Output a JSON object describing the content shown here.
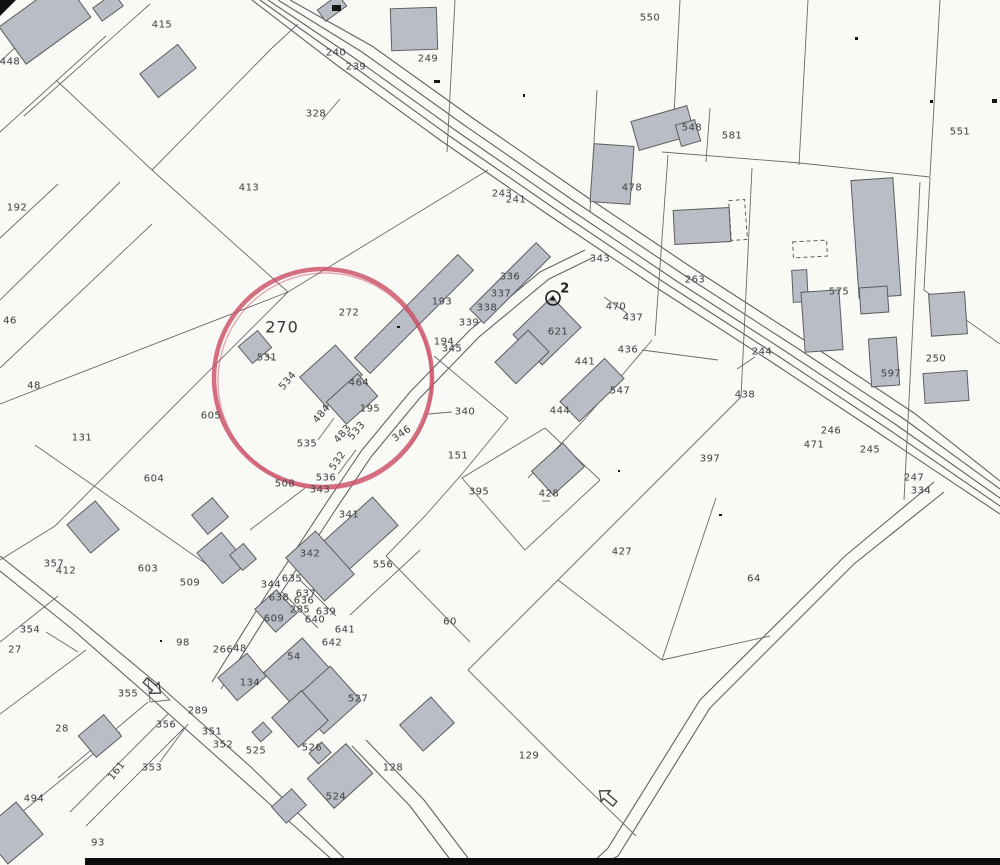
{
  "map": {
    "type": "cadastral-parcel-map",
    "highlight": {
      "label": "270",
      "cx": 323,
      "cy": 378,
      "rx": 109,
      "ry": 109,
      "color": "#cb4c63"
    },
    "colors": {
      "paper": "#f9f9f6",
      "line": "#6b6b6b",
      "building_fill": "#b9bdc5",
      "building_stroke": "#5e5e5e",
      "text": "#474747",
      "highlight_circle": "#cb4c63"
    },
    "symbols": [
      {
        "name": "benchmark-icon",
        "label": "2",
        "x": 553,
        "y": 298
      },
      {
        "name": "road-arrow-icon",
        "x": 152,
        "y": 686,
        "rot": 40
      },
      {
        "name": "road-arrow-icon",
        "x": 608,
        "y": 798,
        "rot": 220
      }
    ],
    "labels": [
      {
        "t": "448",
        "x": 10,
        "y": 62
      },
      {
        "t": "415",
        "x": 162,
        "y": 25
      },
      {
        "t": "240",
        "x": 336,
        "y": 53
      },
      {
        "t": "239",
        "x": 356,
        "y": 67
      },
      {
        "t": "328",
        "x": 316,
        "y": 114
      },
      {
        "t": "413",
        "x": 249,
        "y": 188
      },
      {
        "t": "192",
        "x": 17,
        "y": 208
      },
      {
        "t": "249",
        "x": 428,
        "y": 59
      },
      {
        "t": "550",
        "x": 650,
        "y": 18
      },
      {
        "t": "243",
        "x": 502,
        "y": 194
      },
      {
        "t": "241",
        "x": 516,
        "y": 200
      },
      {
        "t": "478",
        "x": 632,
        "y": 188
      },
      {
        "t": "548",
        "x": 692,
        "y": 128
      },
      {
        "t": "581",
        "x": 732,
        "y": 136
      },
      {
        "t": "551",
        "x": 960,
        "y": 132
      },
      {
        "t": "263",
        "x": 695,
        "y": 280
      },
      {
        "t": "244",
        "x": 762,
        "y": 352
      },
      {
        "t": "438",
        "x": 745,
        "y": 395
      },
      {
        "t": "246",
        "x": 831,
        "y": 431
      },
      {
        "t": "471",
        "x": 814,
        "y": 445
      },
      {
        "t": "245",
        "x": 870,
        "y": 450
      },
      {
        "t": "247",
        "x": 914,
        "y": 478
      },
      {
        "t": "334",
        "x": 921,
        "y": 491
      },
      {
        "t": "575",
        "x": 839,
        "y": 292
      },
      {
        "t": "597",
        "x": 891,
        "y": 374
      },
      {
        "t": "250",
        "x": 936,
        "y": 359
      },
      {
        "t": "343",
        "x": 600,
        "y": 259
      },
      {
        "t": "470",
        "x": 616,
        "y": 307
      },
      {
        "t": "437",
        "x": 633,
        "y": 318
      },
      {
        "t": "436",
        "x": 628,
        "y": 350
      },
      {
        "t": "2",
        "x": 565,
        "y": 289,
        "cls": "bold"
      },
      {
        "t": "621",
        "x": 558,
        "y": 332
      },
      {
        "t": "336",
        "x": 510,
        "y": 277
      },
      {
        "t": "337",
        "x": 501,
        "y": 294
      },
      {
        "t": "338",
        "x": 487,
        "y": 308
      },
      {
        "t": "339",
        "x": 469,
        "y": 323
      },
      {
        "t": "193",
        "x": 442,
        "y": 302
      },
      {
        "t": "194",
        "x": 444,
        "y": 342
      },
      {
        "t": "345",
        "x": 452,
        "y": 349
      },
      {
        "t": "441",
        "x": 585,
        "y": 362
      },
      {
        "t": "547",
        "x": 620,
        "y": 391
      },
      {
        "t": "444",
        "x": 560,
        "y": 411
      },
      {
        "t": "340",
        "x": 465,
        "y": 412
      },
      {
        "t": "151",
        "x": 458,
        "y": 456
      },
      {
        "t": "395",
        "x": 479,
        "y": 492
      },
      {
        "t": "428",
        "x": 549,
        "y": 494
      },
      {
        "t": "427",
        "x": 622,
        "y": 552
      },
      {
        "t": "397",
        "x": 710,
        "y": 459
      },
      {
        "t": "64",
        "x": 754,
        "y": 579
      },
      {
        "t": "60",
        "x": 450,
        "y": 622
      },
      {
        "t": "129",
        "x": 529,
        "y": 756
      },
      {
        "t": "128",
        "x": 393,
        "y": 768
      },
      {
        "t": "46",
        "x": 10,
        "y": 321
      },
      {
        "t": "48",
        "x": 34,
        "y": 386
      },
      {
        "t": "131",
        "x": 82,
        "y": 438
      },
      {
        "t": "605",
        "x": 211,
        "y": 416
      },
      {
        "t": "604",
        "x": 154,
        "y": 479
      },
      {
        "t": "357",
        "x": 54,
        "y": 564
      },
      {
        "t": "412",
        "x": 66,
        "y": 571
      },
      {
        "t": "354",
        "x": 30,
        "y": 630
      },
      {
        "t": "27",
        "x": 15,
        "y": 650
      },
      {
        "t": "355",
        "x": 128,
        "y": 694
      },
      {
        "t": "28",
        "x": 62,
        "y": 729
      },
      {
        "t": "356",
        "x": 166,
        "y": 725
      },
      {
        "t": "353",
        "x": 152,
        "y": 768
      },
      {
        "t": "161",
        "x": 117,
        "y": 771,
        "rot": -52
      },
      {
        "t": "494",
        "x": 34,
        "y": 799
      },
      {
        "t": "93",
        "x": 98,
        "y": 843
      },
      {
        "t": "603",
        "x": 148,
        "y": 569
      },
      {
        "t": "509",
        "x": 190,
        "y": 583
      },
      {
        "t": "98",
        "x": 183,
        "y": 643
      },
      {
        "t": "266",
        "x": 223,
        "y": 650
      },
      {
        "t": "48",
        "x": 240,
        "y": 649
      },
      {
        "t": "289",
        "x": 198,
        "y": 711
      },
      {
        "t": "351",
        "x": 212,
        "y": 732
      },
      {
        "t": "352",
        "x": 223,
        "y": 745
      },
      {
        "t": "134",
        "x": 250,
        "y": 683
      },
      {
        "t": "270",
        "x": 282,
        "y": 327,
        "cls": "big"
      },
      {
        "t": "272",
        "x": 349,
        "y": 313
      },
      {
        "t": "531",
        "x": 267,
        "y": 358
      },
      {
        "t": "534",
        "x": 288,
        "y": 381,
        "rot": -50
      },
      {
        "t": "464",
        "x": 359,
        "y": 383
      },
      {
        "t": "195",
        "x": 370,
        "y": 409
      },
      {
        "t": "484",
        "x": 322,
        "y": 414,
        "rot": -50
      },
      {
        "t": "483",
        "x": 343,
        "y": 434,
        "rot": -50
      },
      {
        "t": "533",
        "x": 357,
        "y": 431,
        "rot": -50
      },
      {
        "t": "532",
        "x": 338,
        "y": 461,
        "rot": -55
      },
      {
        "t": "535",
        "x": 307,
        "y": 444
      },
      {
        "t": "536",
        "x": 326,
        "y": 478
      },
      {
        "t": "508",
        "x": 285,
        "y": 484
      },
      {
        "t": "343",
        "x": 320,
        "y": 490
      },
      {
        "t": "346",
        "x": 402,
        "y": 434,
        "rot": -35
      },
      {
        "t": "341",
        "x": 349,
        "y": 515
      },
      {
        "t": "342",
        "x": 310,
        "y": 554
      },
      {
        "t": "556",
        "x": 383,
        "y": 565
      },
      {
        "t": "344",
        "x": 271,
        "y": 585
      },
      {
        "t": "635",
        "x": 292,
        "y": 579
      },
      {
        "t": "637",
        "x": 306,
        "y": 594
      },
      {
        "t": "638",
        "x": 279,
        "y": 598
      },
      {
        "t": "636",
        "x": 304,
        "y": 601
      },
      {
        "t": "285",
        "x": 300,
        "y": 610
      },
      {
        "t": "639",
        "x": 326,
        "y": 612
      },
      {
        "t": "640",
        "x": 315,
        "y": 620
      },
      {
        "t": "609",
        "x": 274,
        "y": 619
      },
      {
        "t": "641",
        "x": 345,
        "y": 630
      },
      {
        "t": "642",
        "x": 332,
        "y": 643
      },
      {
        "t": "54",
        "x": 294,
        "y": 657
      },
      {
        "t": "527",
        "x": 358,
        "y": 699
      },
      {
        "t": "525",
        "x": 256,
        "y": 751
      },
      {
        "t": "526",
        "x": 312,
        "y": 748
      },
      {
        "t": "524",
        "x": 336,
        "y": 797
      }
    ]
  }
}
